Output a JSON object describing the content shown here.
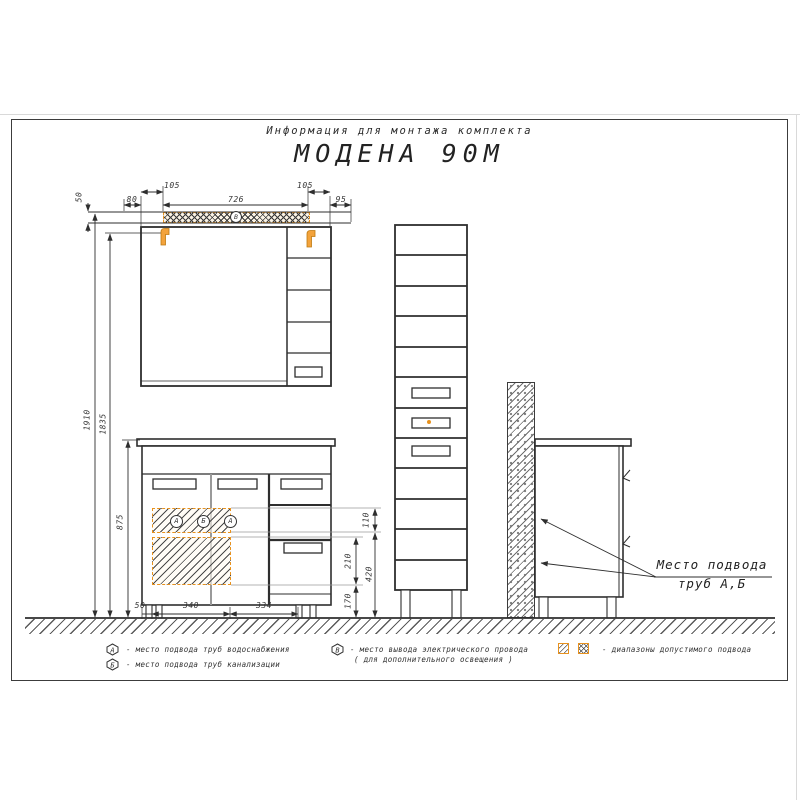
{
  "sheet": {
    "subtitle": "Информация для монтажа комплекта",
    "model": "МОДЕНА 90М"
  },
  "dims": {
    "top105l": "105",
    "top105r": "105",
    "top80": "80",
    "top726": "726",
    "top95": "95",
    "top50": "50",
    "h1910": "1910",
    "h1835": "1835",
    "h875": "875",
    "b50": "50",
    "b340": "340",
    "b334": "334",
    "r110": "110",
    "r210": "210",
    "r170": "170",
    "r420": "420"
  },
  "markers": {
    "strip": "В",
    "zone": [
      "А",
      "Б",
      "А"
    ]
  },
  "note": {
    "line1": "Место подвода",
    "line2": "труб А,Б"
  },
  "legend": {
    "items": [
      {
        "symbol": "А",
        "text": "-  место подвода труб водоснабжения"
      },
      {
        "symbol": "Б",
        "text": "-  место подвода труб канализации"
      },
      {
        "symbol": "В",
        "text": "-  место вывода электрического провода",
        "text2": "( для дополнительного освещения )"
      },
      {
        "text": "-  диапазоны допустимого подвода"
      }
    ]
  },
  "colors": {
    "accent": "#E8921E",
    "line": "#2F2F2F",
    "grey": "#9A9A9A"
  }
}
